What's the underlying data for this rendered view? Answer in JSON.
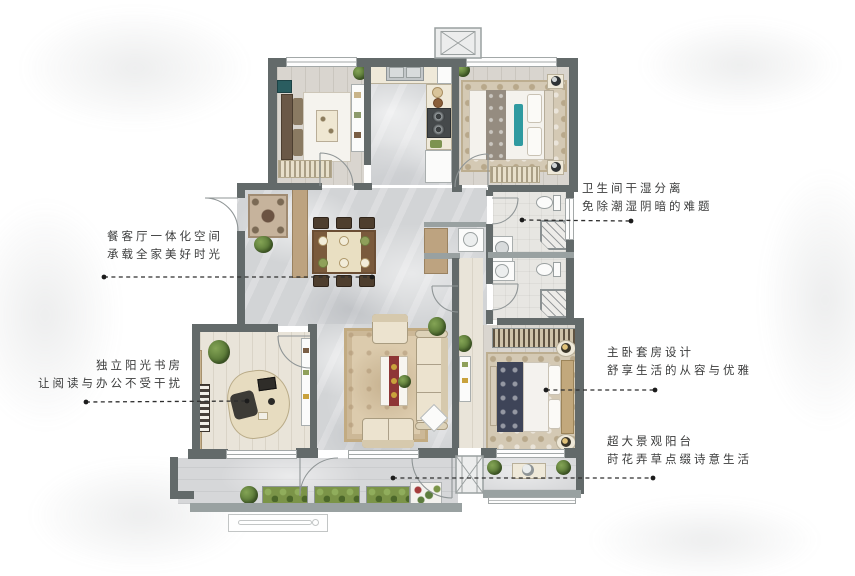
{
  "annotations": {
    "bathroom": {
      "line1": "卫生间干湿分离",
      "line2": "免除潮湿阴暗的难题"
    },
    "dining": {
      "line1": "餐客厅一体化空间",
      "line2": "承载全家美好时光"
    },
    "study": {
      "line1": "独立阳光书房",
      "line2": "让阅读与办公不受干扰"
    },
    "master": {
      "line1": "主卧套房设计",
      "line2": "舒享生活的从容与优雅"
    },
    "balcony": {
      "line1": "超大景观阳台",
      "line2": "莳花弄草点缀诗意生活"
    }
  },
  "colors": {
    "wall": "#636a6a",
    "leader": "#1c1c1c",
    "text": "#3c3d3d"
  }
}
